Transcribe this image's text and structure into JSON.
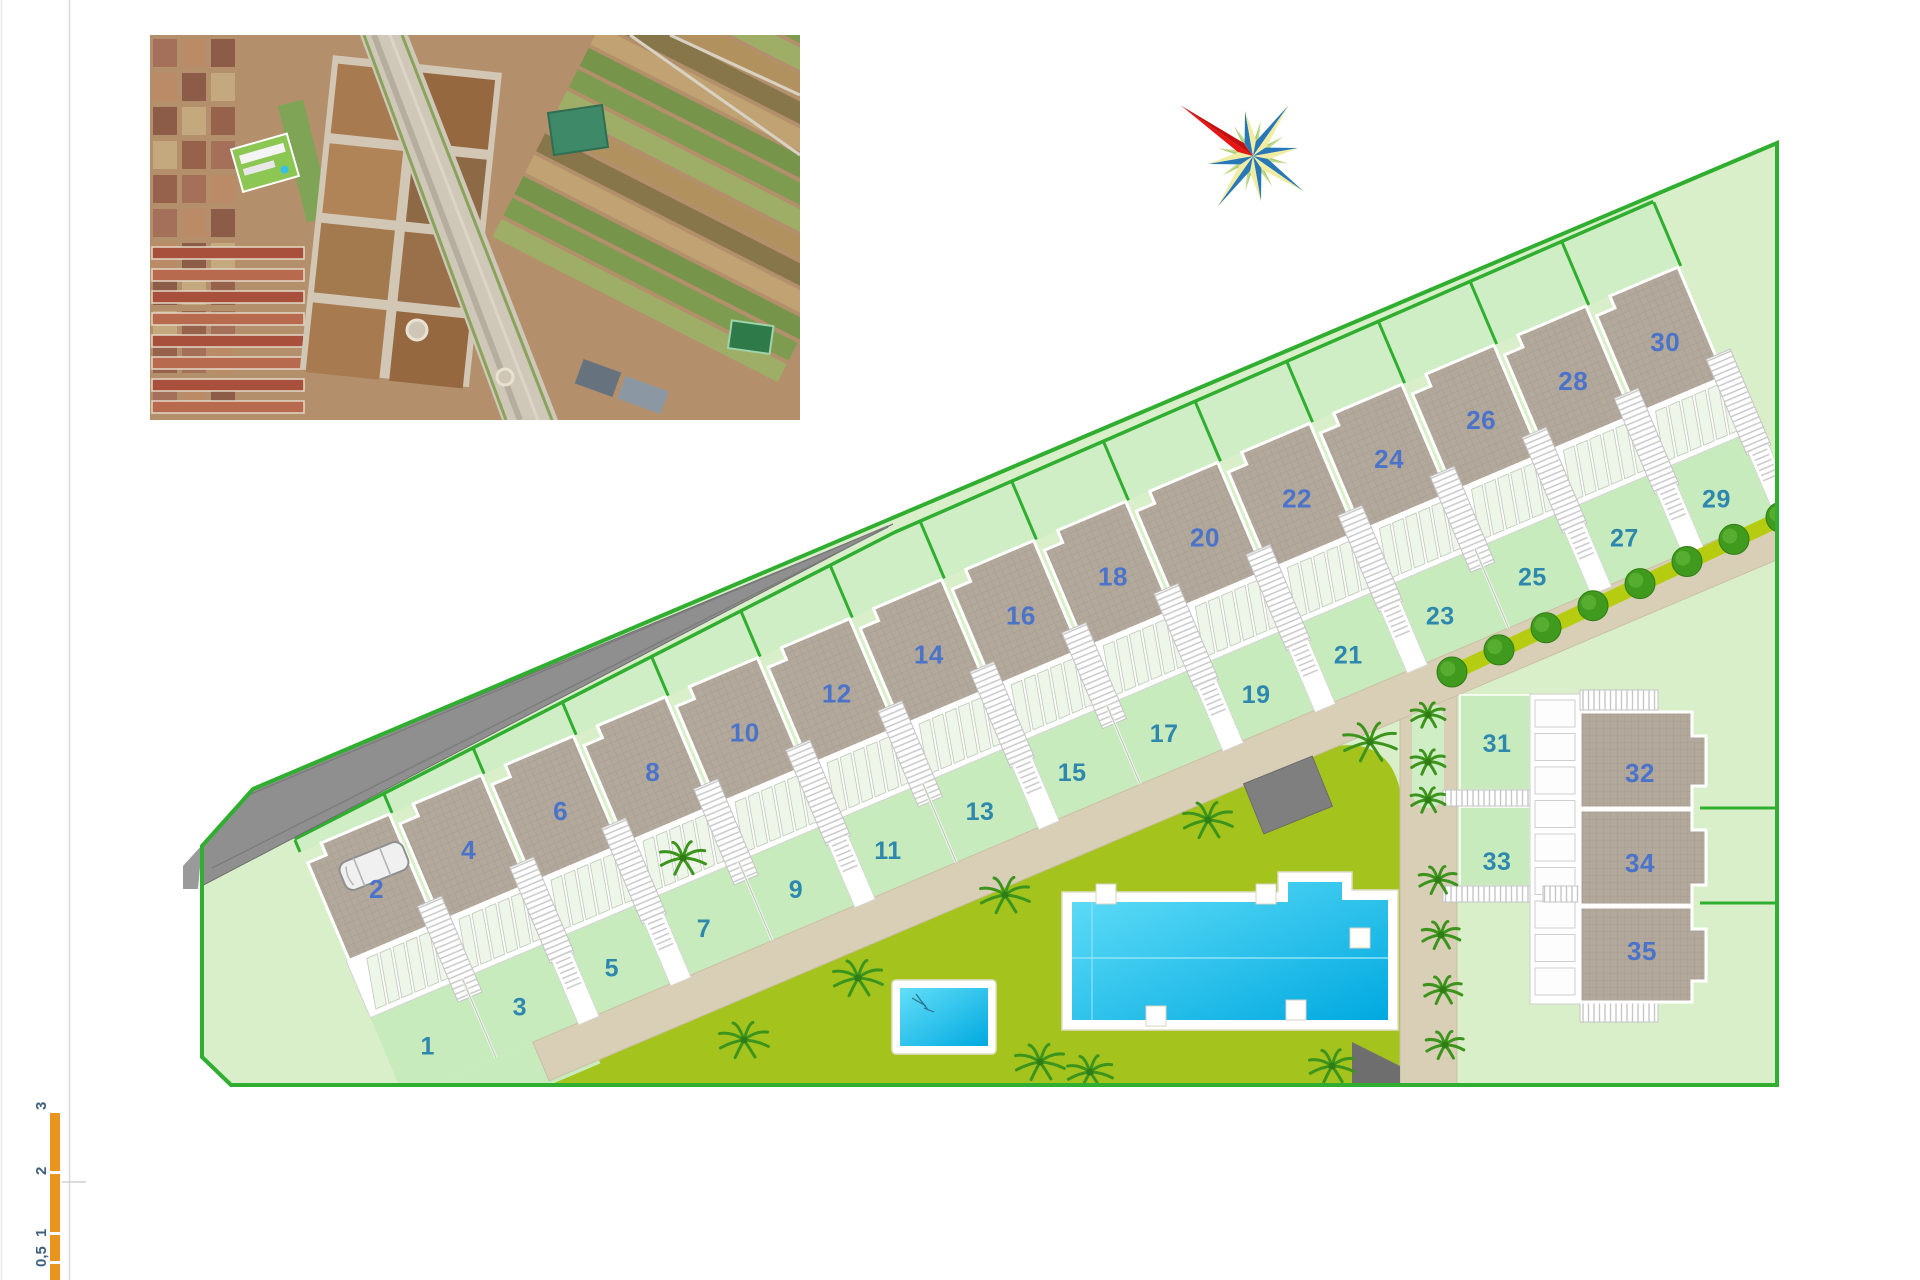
{
  "plan": {
    "title": "residential development site plan",
    "row_plots": [
      {
        "garden": "1",
        "roof": "2"
      },
      {
        "garden": "3",
        "roof": "4"
      },
      {
        "garden": "5",
        "roof": "6"
      },
      {
        "garden": "7",
        "roof": "8"
      },
      {
        "garden": "9",
        "roof": "10"
      },
      {
        "garden": "11",
        "roof": "12"
      },
      {
        "garden": "13",
        "roof": "14"
      },
      {
        "garden": "15",
        "roof": "16"
      },
      {
        "garden": "17",
        "roof": "18"
      },
      {
        "garden": "19",
        "roof": "20"
      },
      {
        "garden": "21",
        "roof": "22"
      },
      {
        "garden": "23",
        "roof": "24"
      },
      {
        "garden": "25",
        "roof": "26"
      },
      {
        "garden": "27",
        "roof": "28"
      },
      {
        "garden": "29",
        "roof": "30"
      }
    ],
    "right_cluster": {
      "gardens": [
        "31",
        "33"
      ],
      "roofs": [
        "32",
        "34",
        "35"
      ]
    },
    "scale_bar": {
      "labels": [
        "0,5",
        "1",
        "2",
        "3"
      ]
    },
    "colors": {
      "site_green": "#d9efca",
      "plot_green": "#c8ebbd",
      "back_garden_green": "#cfeec5",
      "border_green": "#2fae2f",
      "roof_gray": "#b2a89b",
      "path_tan": "#d8cfb6",
      "lawn_olive": "#a4c31d",
      "hedge_olive": "#b5cc10",
      "tree_green": "#3f9a1e",
      "palm_green": "#3c941c",
      "pool_blue": "#18bdec",
      "driveway_gray": "#8f8f8f",
      "shed_gray": "#6e6e6e",
      "number_blue": "#4a73c9",
      "number_teal": "#2e87ad",
      "scale_orange": "#e8941e",
      "compass_red": "#e81410",
      "compass_blue": "#2878b8",
      "compass_yellow": "#f0eca2"
    }
  }
}
